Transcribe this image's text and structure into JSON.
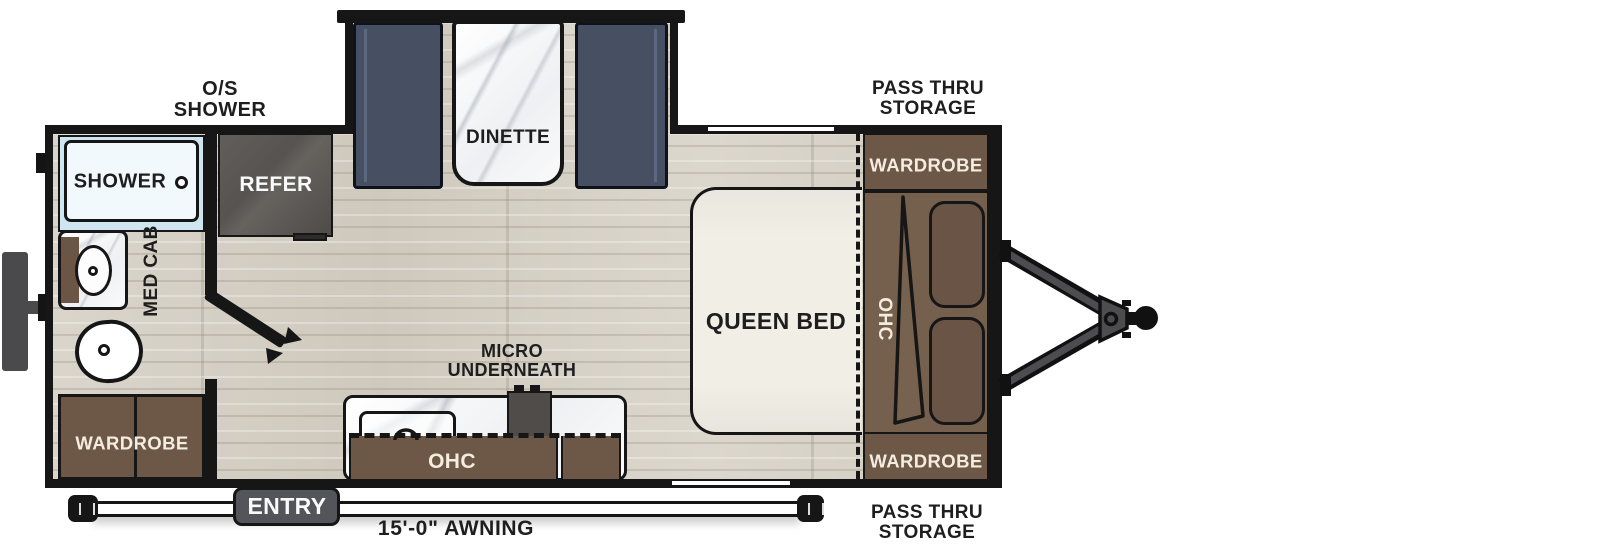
{
  "colors": {
    "wall_black": "#161616",
    "floor_wood": "#d7d2c8",
    "cabinet_brown": "#6d5747",
    "headboard_brown": "#75604e",
    "pillow_brown": "#6a5445",
    "bench_slate": "#465062",
    "appliance_gray": "#575350",
    "entry_gray": "#54555a",
    "shower_blue": "#cfe6f0",
    "mattress_cream": "#f1eee6",
    "label_dark": "#1e1e1e",
    "label_cream": "#f4ecdf"
  },
  "exterior_labels": {
    "os_shower": {
      "line1": "O/S",
      "line2": "SHOWER"
    },
    "pass_thru_top": {
      "line1": "PASS THRU",
      "line2": "STORAGE"
    },
    "pass_thru_bottom": {
      "line1": "PASS THRU",
      "line2": "STORAGE"
    },
    "awning": "15'-0\" AWNING"
  },
  "rooms": {
    "dinette": "DINETTE",
    "shower": "SHOWER",
    "refer": "REFER",
    "med_cab": "MED CAB",
    "queen_bed": "QUEEN BED",
    "bed_ohc": "OHC",
    "wardrobe_top": "WARDROBE",
    "wardrobe_rear": "WARDROBE",
    "wardrobe_front": "WARDROBE",
    "micro": {
      "line1": "MICRO",
      "line2": "UNDERNEATH"
    },
    "kitchen_ohc": "OHC",
    "entry": "ENTRY"
  }
}
